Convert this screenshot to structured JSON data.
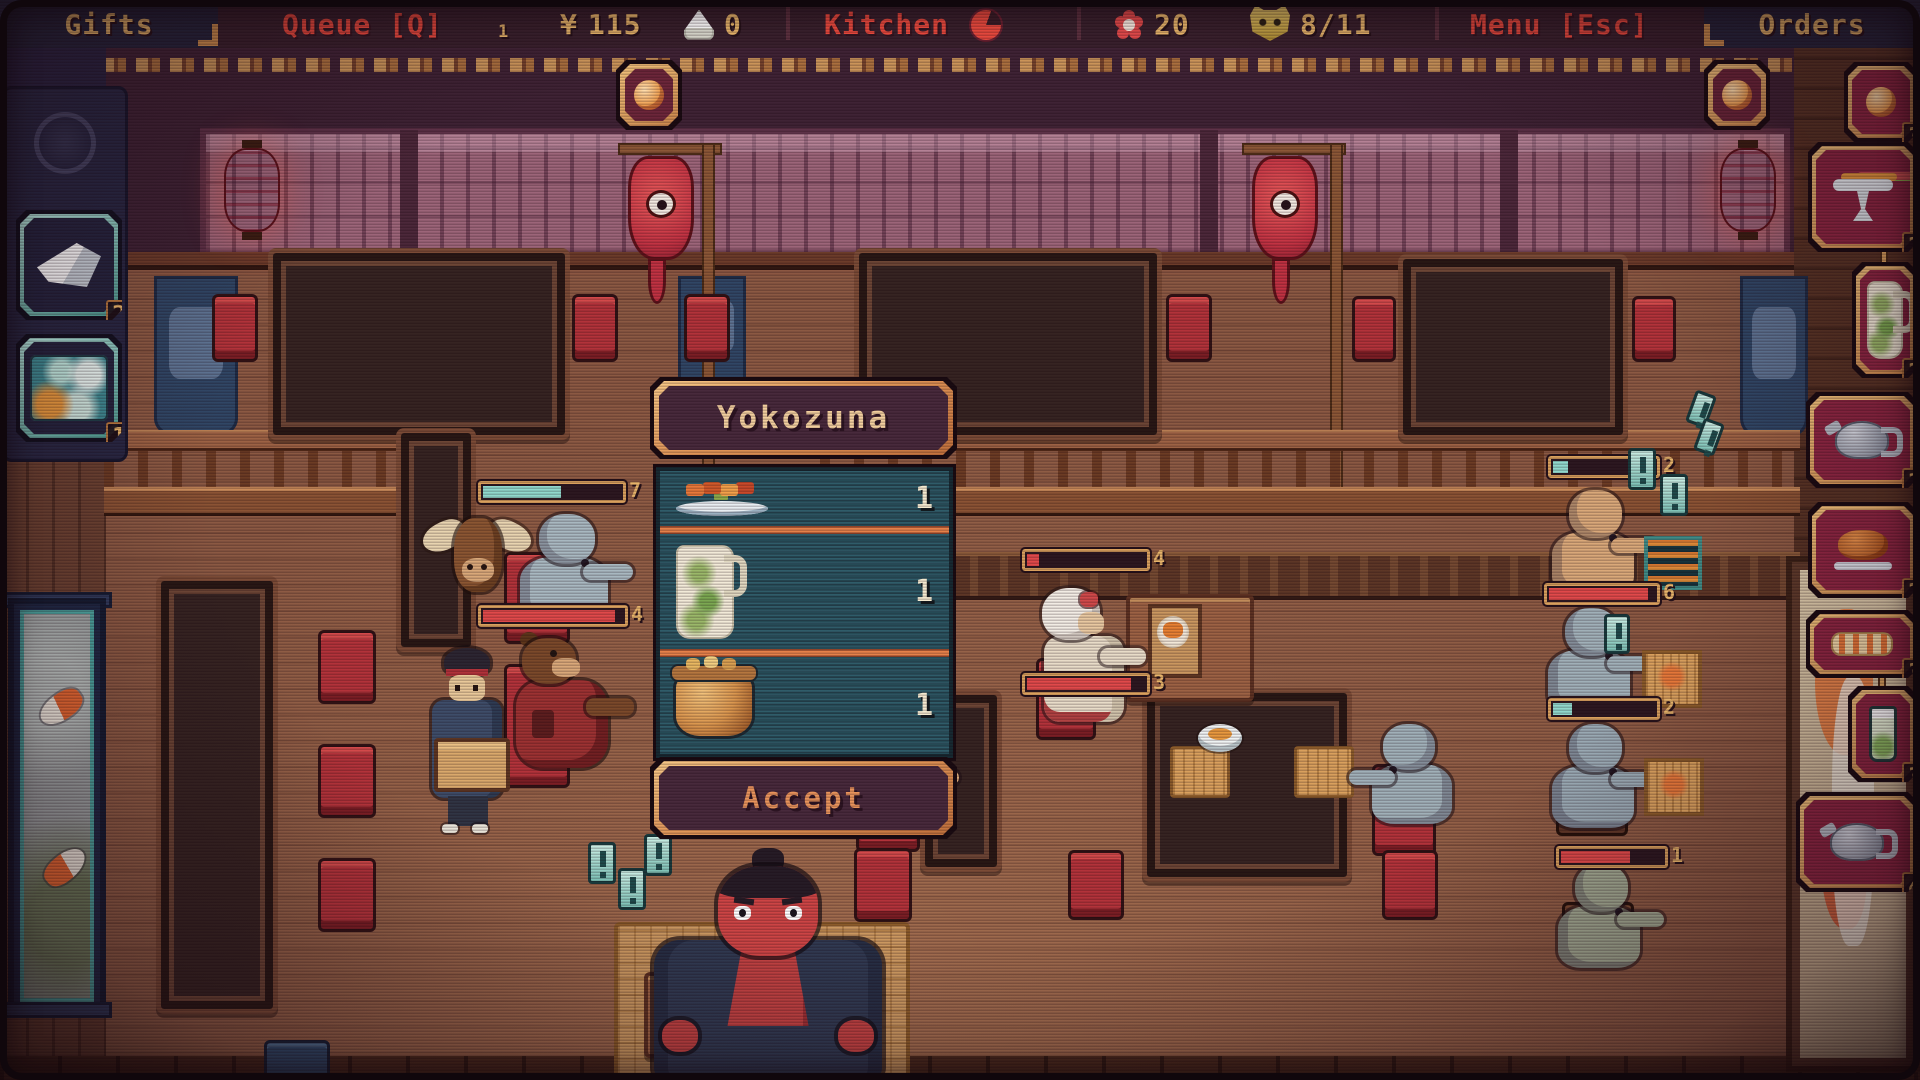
{
  "top_bar": {
    "gifts": "Gifts",
    "queue": "Queue [Q]",
    "queue_count": "1",
    "currency": "¥",
    "money": "115",
    "rice_balls": "0",
    "kitchen": "Kitchen",
    "flowers": "20",
    "masks": "8/11",
    "menu": "Menu [Esc]",
    "orders": "Orders"
  },
  "order_dialog": {
    "title": "Yokozuna",
    "accept": "Accept",
    "items": [
      {
        "icon": "sashimi-platter",
        "qty": "1"
      },
      {
        "icon": "bamboo-pitcher",
        "qty": "1"
      },
      {
        "icon": "rice-pot",
        "qty": "1"
      }
    ]
  },
  "gifts_panel": {
    "slots": [
      {
        "icon": "faded-emblem",
        "count": ""
      },
      {
        "icon": "folded-paper",
        "count": "2"
      },
      {
        "icon": "wave-painting",
        "count": "1"
      }
    ]
  },
  "orders_panel": {
    "slots": [
      {
        "icon": "peach",
        "count": "3"
      },
      {
        "icon": "fruit-stand",
        "count": "2"
      },
      {
        "icon": "bamboo-pitcher",
        "count": "2"
      },
      {
        "icon": "teapot",
        "count": "2"
      },
      {
        "icon": "roast-platter",
        "count": "2"
      },
      {
        "icon": "sushi-roll",
        "count": "3"
      },
      {
        "icon": "iced-drink",
        "count": "3"
      },
      {
        "icon": "teapot",
        "count": "4"
      }
    ]
  },
  "scene": {
    "patience_bars": [
      {
        "value": "7"
      },
      {
        "value": "4"
      },
      {
        "value": "4"
      },
      {
        "value": "3"
      },
      {
        "value": "2"
      },
      {
        "value": "6"
      },
      {
        "value": "2"
      },
      {
        "value": "1"
      }
    ]
  },
  "colors": {
    "gold_text": "#e7b469",
    "red_text": "#e8483c",
    "panel_teal": "#2d5b68",
    "frame_orange": "#e09556",
    "slot_crimson": "#8c2440",
    "slot_frame_gold": "#d9a05c",
    "gift_frame_teal": "#8fd8cc",
    "bubble_teal": "#a8e8dc"
  }
}
